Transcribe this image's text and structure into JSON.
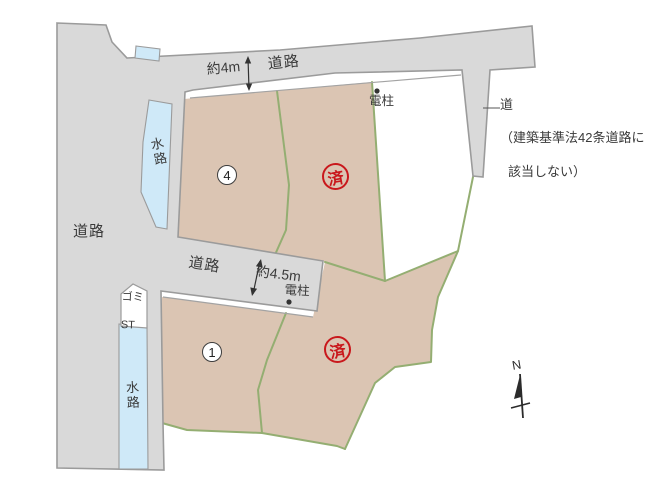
{
  "diagram_title": "分譲地区画図 (residential lot site plan)",
  "roads": {
    "top_label": "道路",
    "left_label": "道路",
    "mid_label": "道路",
    "top_width": "約4m",
    "mid_width": "約4.5m"
  },
  "note": {
    "title": "道",
    "line1": "（建築基準法42条道路に",
    "line2": "該当しない）"
  },
  "features": {
    "pole_top": "電柱",
    "pole_mid": "電柱",
    "waterway_upper": "水路",
    "waterway_lower": "水路",
    "gomi_line1": "ゴミ",
    "gomi_line2": "ST",
    "north": "N"
  },
  "parcels": {
    "lot4_number": "4",
    "lot1_number": "1",
    "sold_upper": "済",
    "sold_lower": "済"
  },
  "colors": {
    "road_fill": "#d9d9d9",
    "road_edge": "#9b9b9b",
    "parcel_fill": "#dbc5b3",
    "boundary_green": "#94ae72",
    "water_fill": "#cfe9f8",
    "stamp_red": "#c9181c",
    "text": "#3a3a3a"
  }
}
